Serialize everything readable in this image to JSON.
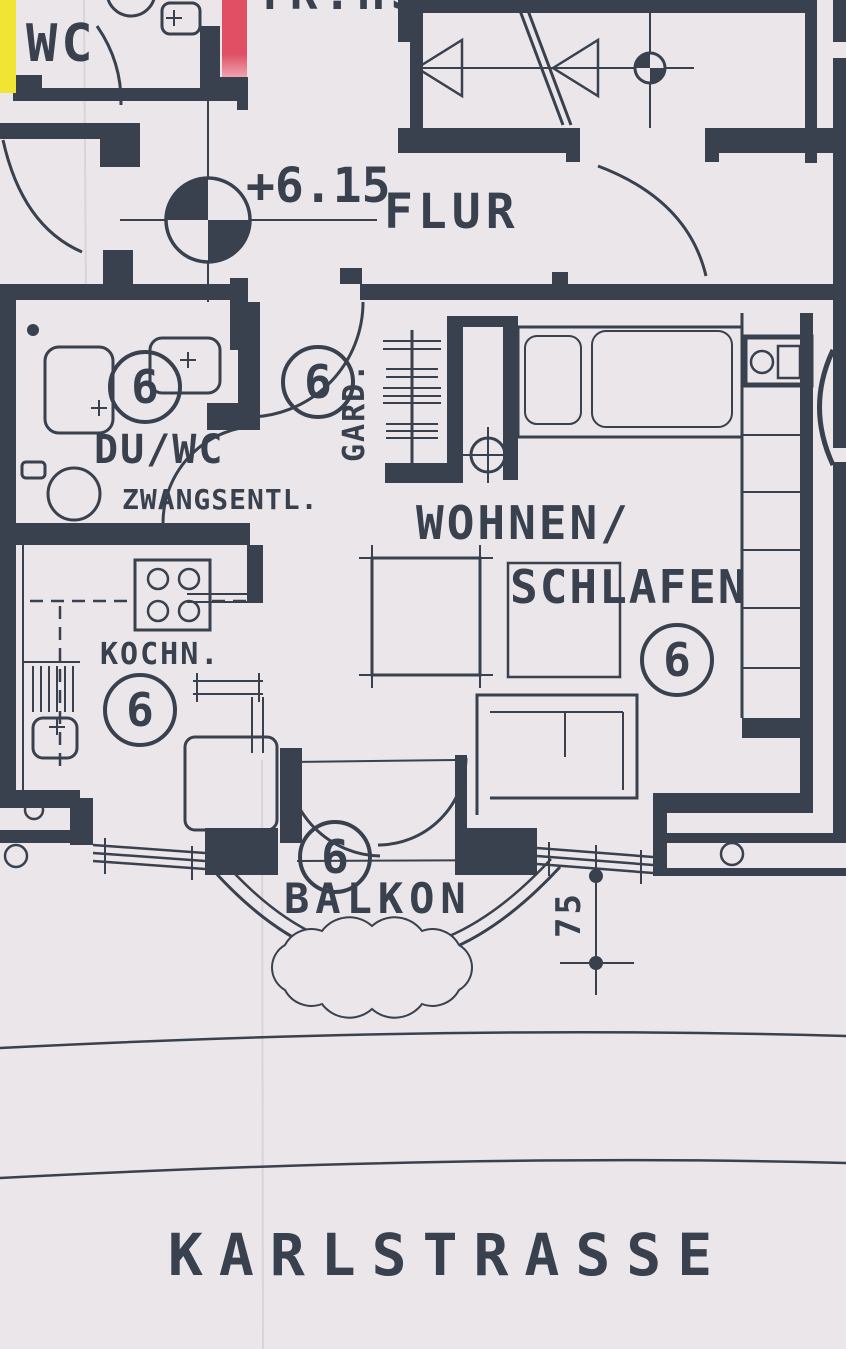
{
  "colors": {
    "ink": "#39414f",
    "paper": "#eae6e9",
    "highlight_yellow": "#f2e433",
    "highlight_red": "#e04f63",
    "highlight_red_light": "#efa3b2"
  },
  "rooms": {
    "stairwell": "TR.HS",
    "wc": "WC",
    "hall": "FLUR",
    "shower_wc": "DU/WC",
    "shower_wc_note": "ZWANGSENTL.",
    "wardrobe": "GARD.",
    "living_line1": "WOHNEN/",
    "living_line2": "SCHLAFEN",
    "kitchen": "KOCHN.",
    "balcony": "BALKON"
  },
  "annotations": {
    "street": "KARLSTRASSE",
    "floor_level": "+6.15",
    "unit_number": "6",
    "balcony_dimension": "75"
  }
}
